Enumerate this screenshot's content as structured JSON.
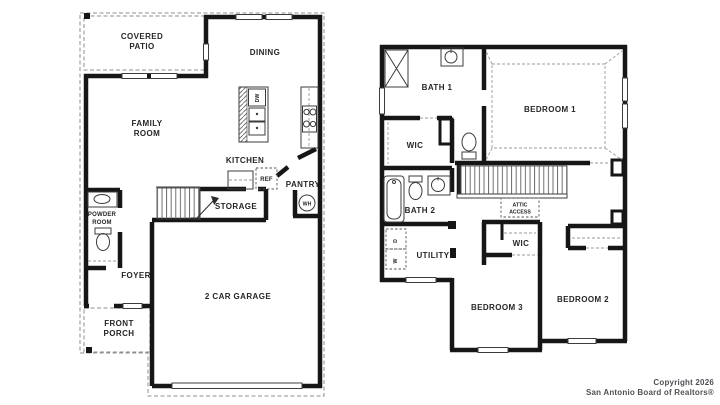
{
  "page": {
    "background": "#ffffff"
  },
  "colors": {
    "wall": "#161616",
    "label": "#262626",
    "dashed_line": "#8f8f8f",
    "footer_text": "#4f5156"
  },
  "first_floor": {
    "covered_patio": [
      "COVERED",
      "PATIO"
    ],
    "dining": "DINING",
    "family_room": [
      "FAMILY",
      "ROOM"
    ],
    "kitchen": "KITCHEN",
    "dishwasher": "DW",
    "refrigerator": "REF",
    "pantry": "PANTRY",
    "water_heater": "WH",
    "storage": "STORAGE",
    "powder_room": [
      "POWDER",
      "ROOM"
    ],
    "foyer": "FOYER",
    "front_porch": [
      "FRONT",
      "PORCH"
    ],
    "garage": "2 CAR GARAGE"
  },
  "second_floor": {
    "bath1": "BATH 1",
    "bedroom1": "BEDROOM 1",
    "wic_upper": "WIC",
    "bath2": "BATH 2",
    "attic_access": [
      "ATTIC",
      "ACCESS"
    ],
    "utility": "UTILITY",
    "dryer": "D",
    "washer": "W",
    "wic_middle": "WIC",
    "bedroom3": "BEDROOM 3",
    "bedroom2": "BEDROOM 2"
  },
  "footer": {
    "line1": "Copyright 2026",
    "line2": "San Antonio Board of Realtors®"
  }
}
